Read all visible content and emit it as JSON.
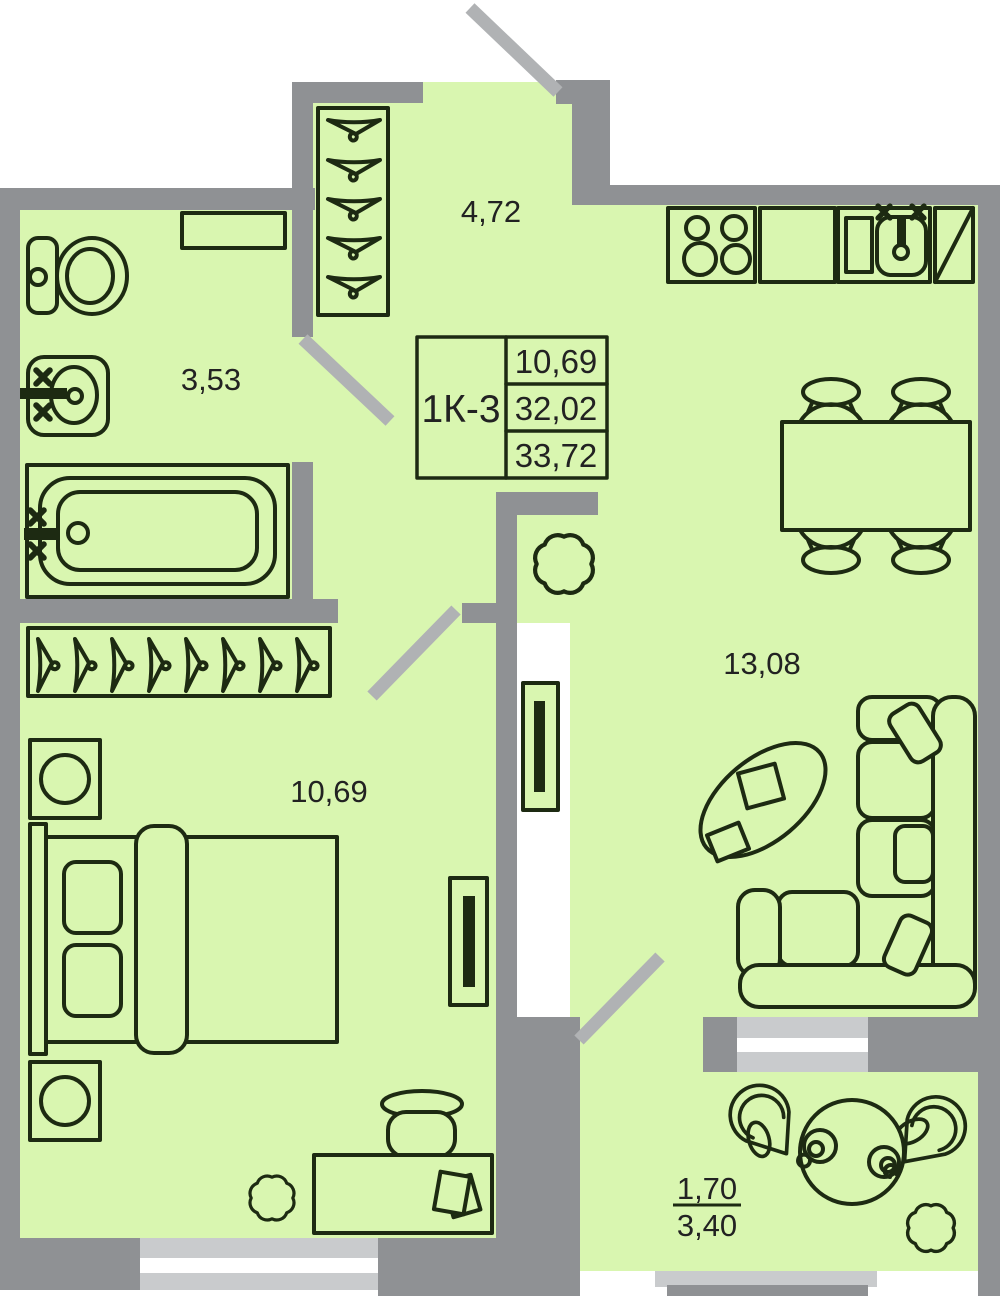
{
  "plan": {
    "title_block": {
      "unit": "1К-3",
      "values": [
        "10,69",
        "32,02",
        "33,72"
      ]
    },
    "labels": {
      "hall": "4,72",
      "bathroom": "3,53",
      "bedroom": "10,69",
      "kitchen_living": "13,08",
      "balcony_reduced": "1,70",
      "balcony_full": "3,40"
    },
    "colors": {
      "floor": "#d9f6b0",
      "wall": "#8f9194",
      "door": "#b0b2b4",
      "window_frame": "#c9cbcd",
      "line": "#1d2a12",
      "text": "#222222"
    }
  }
}
